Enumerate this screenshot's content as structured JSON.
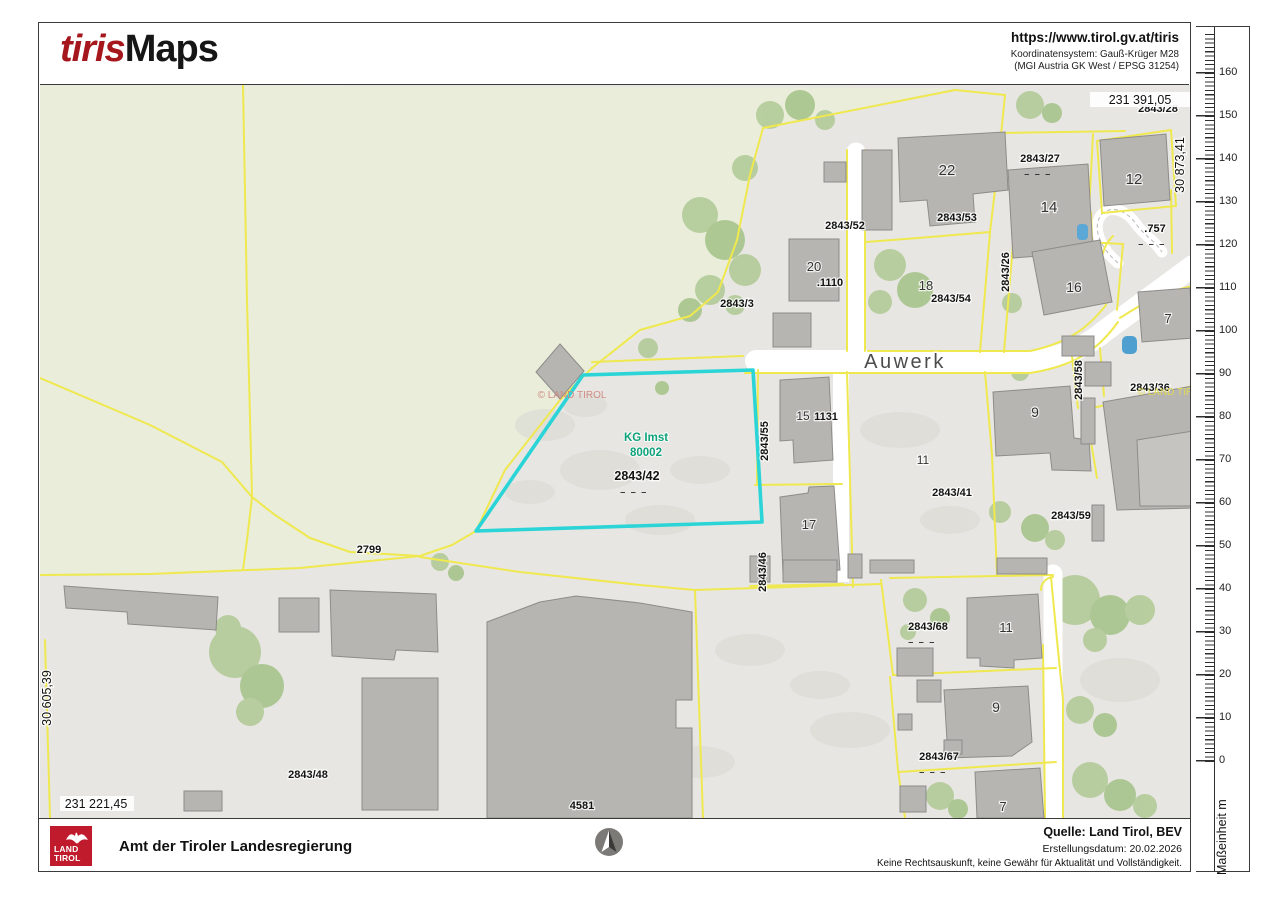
{
  "header": {
    "logo_primary": "tiris",
    "logo_secondary": "Maps",
    "url": "https://www.tirol.gv.at/tiris",
    "crs_line1": "Koordinatensystem: Gauß-Krüger M28",
    "crs_line2": "(MGI Austria GK West / EPSG 31254)"
  },
  "map": {
    "street": "Auwerk",
    "kg": {
      "line1": "KG Imst",
      "line2": "80002"
    },
    "dashes": "– – –",
    "watermark": "© LAND TIROL",
    "coords": {
      "top": "231 391,05",
      "right": "30 873,41",
      "left": "30 605,39",
      "bottom": "231 221,45"
    },
    "labels": {
      "p2843_3": "2843/3",
      "p2843_52": "2843/52",
      "p2843_53": "2843/53",
      "n22": "22",
      "p2843_27": "2843/27",
      "n14": "14",
      "n12": "12",
      "p2843_28": "2843/28",
      "p757": ".757",
      "n20": "20",
      "p1110": ".1110",
      "n18": "18",
      "p2843_54": "2843/54",
      "p2843_26": "2843/26",
      "n16": "16",
      "n7_top": "7",
      "p2843_58": "2843/58",
      "p2843_36": "2843/36",
      "n15": "15",
      "n1131": "1131",
      "p2843_55": "2843/55",
      "n9_mid": "9",
      "n17": "17",
      "p2843_46": "2843/46",
      "n11_mid": "11",
      "p2843_41": "2843/41",
      "p2843_59": "2843/59",
      "p2843_42": "2843/42",
      "p2799": "2799",
      "p2843_48": "2843/48",
      "p4581": "4581",
      "p2843_68": "2843/68",
      "n11_bottom": "11",
      "n9_bottom": "9",
      "p2843_67": "2843/67",
      "n7_bottom": "7"
    },
    "colors": {
      "highlight": "#2bd4d6",
      "parcel_line": "#efe84e",
      "building": "#b7b5b2",
      "green_area": "#e9edda",
      "urban_area": "#e8e6e2",
      "kg_label": "#0ea37c"
    }
  },
  "ruler": {
    "unit_label": "Maßeinheit m",
    "major_ticks": [
      "0",
      "10",
      "20",
      "30",
      "40",
      "50",
      "60",
      "70",
      "80",
      "90",
      "100",
      "110",
      "120",
      "130",
      "140",
      "150",
      "160"
    ]
  },
  "footer": {
    "logo_line1": "LAND",
    "logo_line2": "TIROL",
    "title": "Amt der Tiroler Landesregierung",
    "source": "Quelle: Land Tirol, BEV",
    "date_line": "Erstellungsdatum:  20.02.2026",
    "disclaimer": "Keine Rechtsauskunft, keine Gewähr für Aktualität und Vollständigkeit."
  }
}
